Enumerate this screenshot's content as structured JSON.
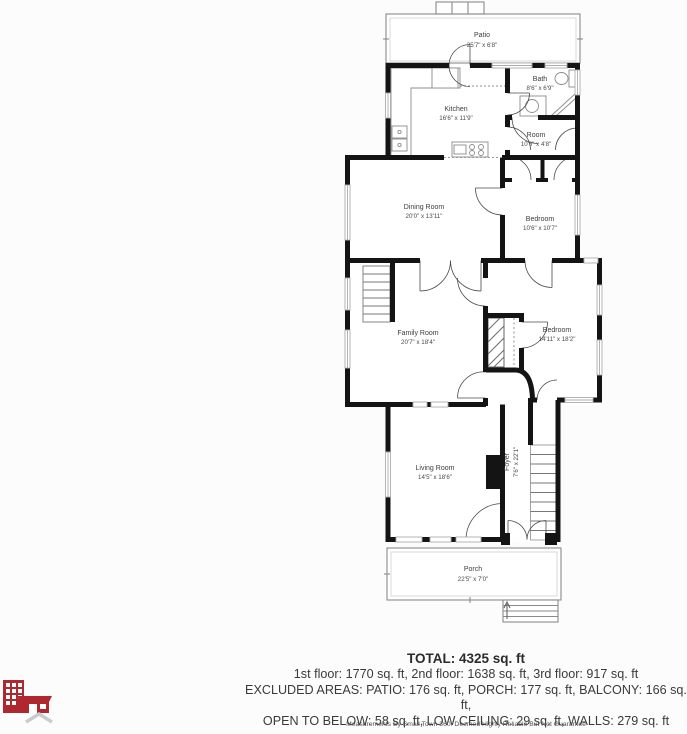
{
  "floorplan": {
    "rooms": [
      {
        "id": "patio",
        "name": "Patio",
        "dims": "25'7\" x 6'8\""
      },
      {
        "id": "kitchen",
        "name": "Kitchen",
        "dims": "16'6\" x 11'9\""
      },
      {
        "id": "bath",
        "name": "Bath",
        "dims": "8'6\" x 6'9\""
      },
      {
        "id": "room",
        "name": "Room",
        "dims": "10'6\" x 4'8\""
      },
      {
        "id": "dining-room",
        "name": "Dining Room",
        "dims": "20'0\" x 13'11\""
      },
      {
        "id": "bedroom-small",
        "name": "Bedroom",
        "dims": "10'6\" x 10'7\""
      },
      {
        "id": "family-room",
        "name": "Family Room",
        "dims": "20'7\" x 18'4\""
      },
      {
        "id": "bedroom-large",
        "name": "Bedroom",
        "dims": "14'11\" x 18'2\""
      },
      {
        "id": "living-room",
        "name": "Living Room",
        "dims": "14'5\" x 18'6\""
      },
      {
        "id": "foyer",
        "name": "Foyer",
        "dims": "7'6\" x 22'1\""
      },
      {
        "id": "porch",
        "name": "Porch",
        "dims": "22'5\" x 7'0\""
      }
    ]
  },
  "summary": {
    "total": "TOTAL: 4325 sq. ft",
    "floors": "1st floor: 1770 sq. ft, 2nd floor: 1638 sq. ft, 3rd floor: 917 sq. ft",
    "excluded1": "EXCLUDED AREAS: PATIO: 176 sq. ft, PORCH: 177 sq. ft, BALCONY: 166 sq. ft,",
    "excluded2": "OPEN TO BELOW: 58 sq. ft, LOW CEILING: 29 sq. ft, WALLS: 279 sq. ft"
  },
  "footer": {
    "disclaimer": "Measurements By Small Town 360. Deemed Highly Reliable But Not Guarantee"
  },
  "branding": {
    "logo_icon": "small-town-360-building-logo",
    "logo_color": "#b0282f",
    "chevron_color": "#c8cbd0",
    "wall_color": "#141414",
    "window_color": "#b0b0b0"
  }
}
